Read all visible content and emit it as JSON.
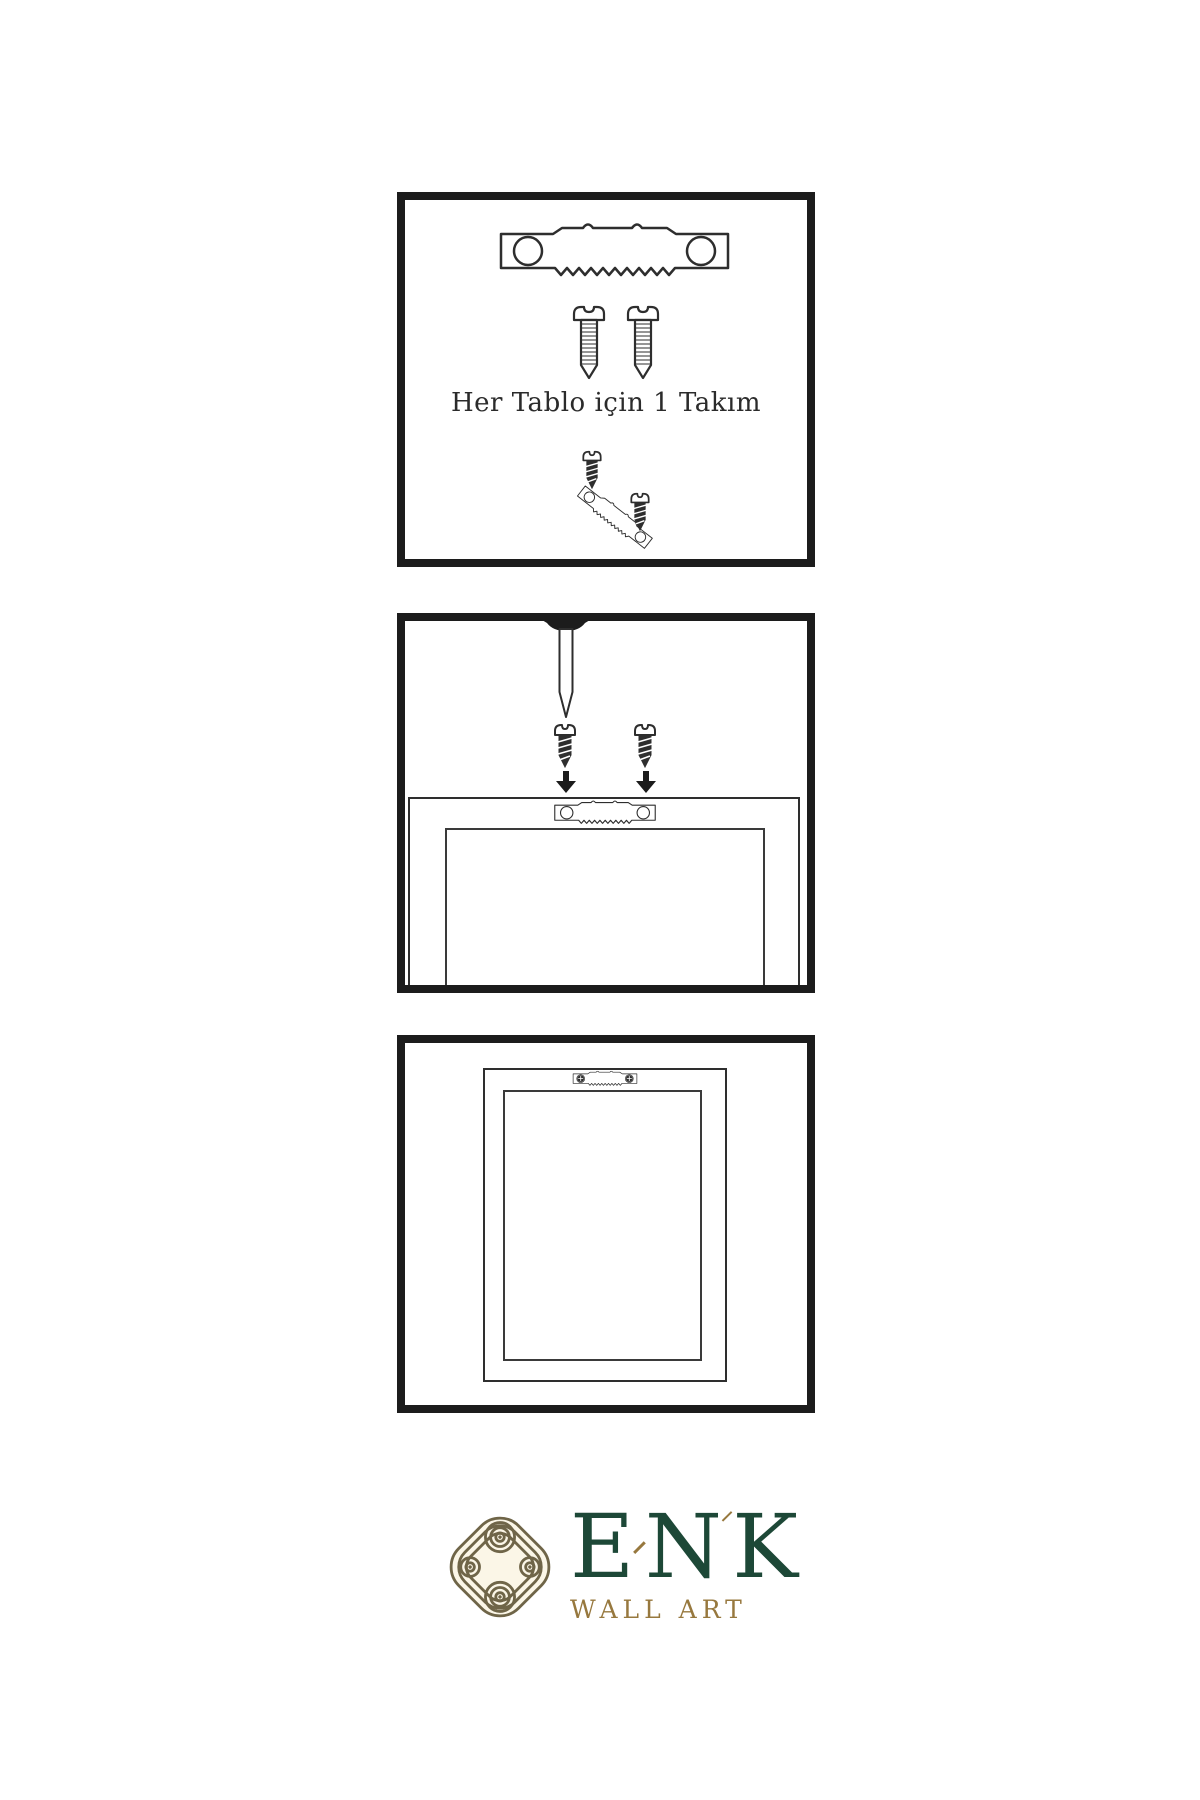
{
  "document": {
    "type": "wall-art-hanging-instructions",
    "background": "#ffffff",
    "panel_border_color": "#1c1c1c",
    "line_color": "#2e2e2e"
  },
  "panel1": {
    "caption": "Her Tablo için 1 Takım",
    "contents": [
      "sawtooth-hanger",
      "two-screws",
      "tilted-hanger-with-screws"
    ]
  },
  "panel2": {
    "contents": [
      "wall-nail",
      "two-screws-with-down-arrows",
      "frame-back-with-sawtooth-hanger"
    ]
  },
  "panel3": {
    "contents": [
      "hung-frame-with-mounted-hanger"
    ]
  },
  "brand": {
    "letters": [
      "E",
      "N",
      "K"
    ],
    "subtitle": "WALL ART",
    "colors": {
      "green": "#1d4837",
      "gold": "#97783e",
      "knot": "#6f6548",
      "cream": "#fbf6e7"
    }
  },
  "icons": {
    "sawtooth_hanger": "sawtooth-hanger-icon",
    "sawtooth_hanger_screwed": "sawtooth-hanger-screwed-icon",
    "light_screw": "screw-icon",
    "dark_screw": "dark-screw-icon",
    "nail": "nail-icon",
    "arrow_down": "arrow-down-icon",
    "knot": "knot-logo-icon",
    "diamond": "diamond-icon"
  }
}
